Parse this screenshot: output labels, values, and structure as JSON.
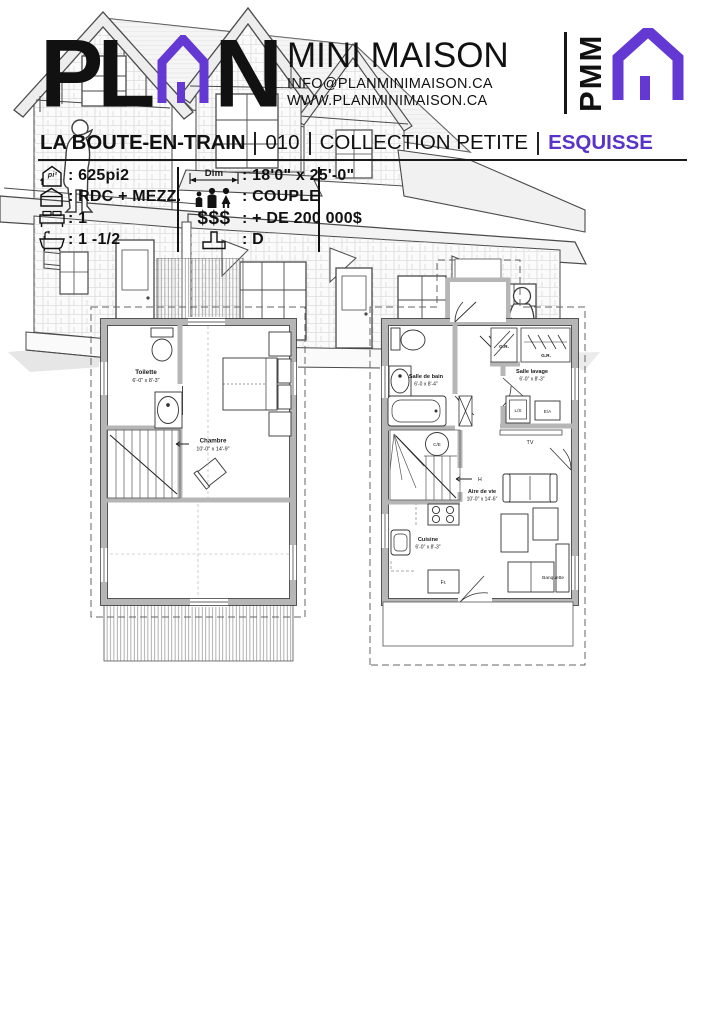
{
  "header": {
    "logo_pl": "PL",
    "logo_n": "N",
    "brand": "MINI MAISON",
    "email": "INFO@PLANMINIMAISON.CA",
    "website": "WWW.PLANMINIMAISON.CA",
    "monogram": "PMM"
  },
  "title_bar": {
    "name": "LA BOUTE-EN-TRAIN",
    "number": "010",
    "collection": "COLLECTION PETITE",
    "stage": "ESQUISSE"
  },
  "specs": {
    "area": ": 625pi2",
    "area_icon_label": "pi²",
    "levels": ": RDC + MEZZ.",
    "bedrooms": ": 1",
    "bathrooms": ": 1 -1/2",
    "dim_label": "Dim",
    "dimensions": ": 18'0\" x 25'-0\"",
    "occupants": ": COUPLE",
    "price_label": "$$$",
    "price": ": + DE 200 000$",
    "foundation": ": D"
  },
  "mezzanine_plan": {
    "toilette_name": "Toilette",
    "toilette_dims": "6'-0\" x 8'-3\"",
    "chambre_name": "Chambre",
    "chambre_dims": "10'-0\" x 14'-9\""
  },
  "rdc_plan": {
    "salle_de_bain_name": "Salle de bain",
    "salle_de_bain_dims": "6'-0 x 8'-4\"",
    "salle_lavage_name": "Salle lavage",
    "salle_lavage_dims": "6'-0\" x 8'-3\"",
    "aire_de_vie_name": "Aire de vie",
    "aire_de_vie_dims": "10'-0\" x 14'-6\"",
    "cuisine_name": "Cuisine",
    "cuisine_dims": "6'-0\" x 8'-3\"",
    "gr1": "G.R.",
    "gr2": "G.R.",
    "washer": "L/S",
    "dryer": "E/A",
    "tv": "TV",
    "water_heater": "C/E",
    "up_label": "H",
    "fridge": "Fr.",
    "banquette": "Banquette"
  },
  "colors": {
    "accent": "#5a33c8",
    "logo_purple": "#6438d2",
    "wall_gray": "#b6b6b6"
  }
}
